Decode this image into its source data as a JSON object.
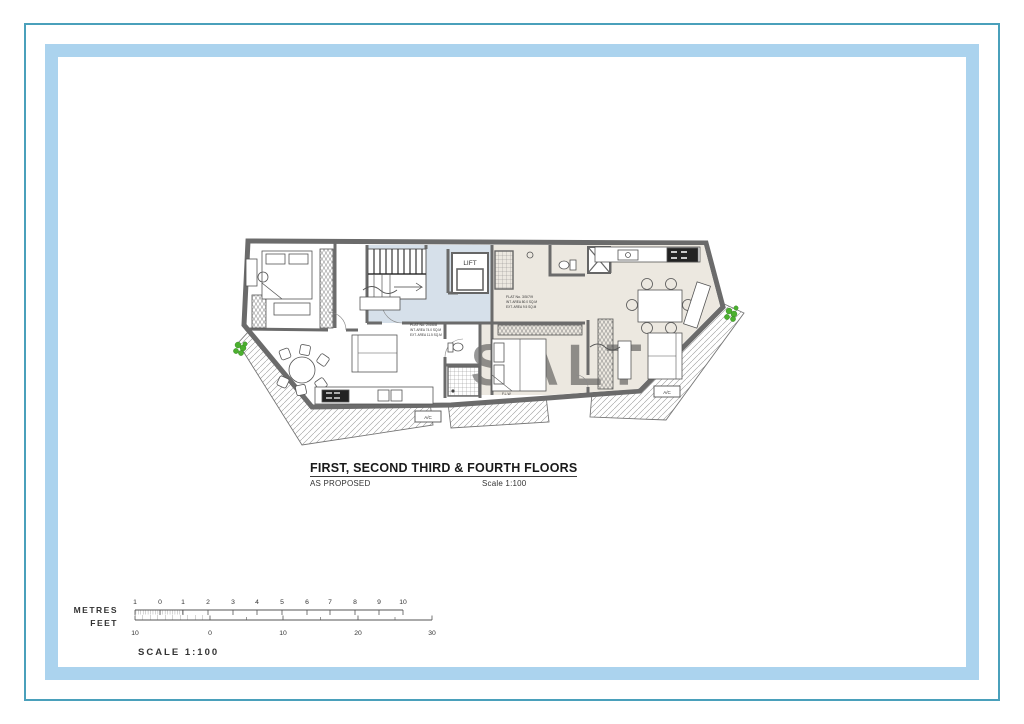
{
  "page": {
    "background": "#ffffff"
  },
  "frame": {
    "outer_border_color": "#4aa0bb",
    "inner_border_color": "#abd3ee"
  },
  "plan": {
    "lift_label": "LIFT",
    "ac_label": "A/C",
    "flw_label": "F.L.W",
    "watermark": "SALT",
    "flat_left": {
      "line1": "FLAT No. 2/4/6/8",
      "line2": "INT. AREA 74.0 SQ.M",
      "line3": "EXT. AREA 11.5 SQ.M"
    },
    "flat_right": {
      "line1": "FLAT No. 3/5/7/9",
      "line2": "INT. AREA 80.0 SQ.M",
      "line3": "EXT. AREA 9.5 SQ.M"
    },
    "colors": {
      "wall": "#6b6b6b",
      "floor_right_flat": "#ece8e0",
      "stair_core": "#d6e0ea",
      "plant_green": "#4bb02e",
      "hatch": "#9a9a9a",
      "watermark_gray": "#dddddd"
    }
  },
  "title_block": {
    "title": "FIRST, SECOND THIRD & FOURTH FLOORS",
    "subtitle": "AS PROPOSED",
    "scale": "Scale 1:100"
  },
  "scale_bar": {
    "metres_label": "METRES",
    "feet_label": "FEET",
    "metres_ticks": [
      "1",
      "0",
      "1",
      "2",
      "3",
      "4",
      "5",
      "6",
      "7",
      "8",
      "9",
      "10"
    ],
    "feet_ticks": [
      "10",
      "0",
      "10",
      "20",
      "30"
    ],
    "caption": "SCALE 1:100"
  }
}
